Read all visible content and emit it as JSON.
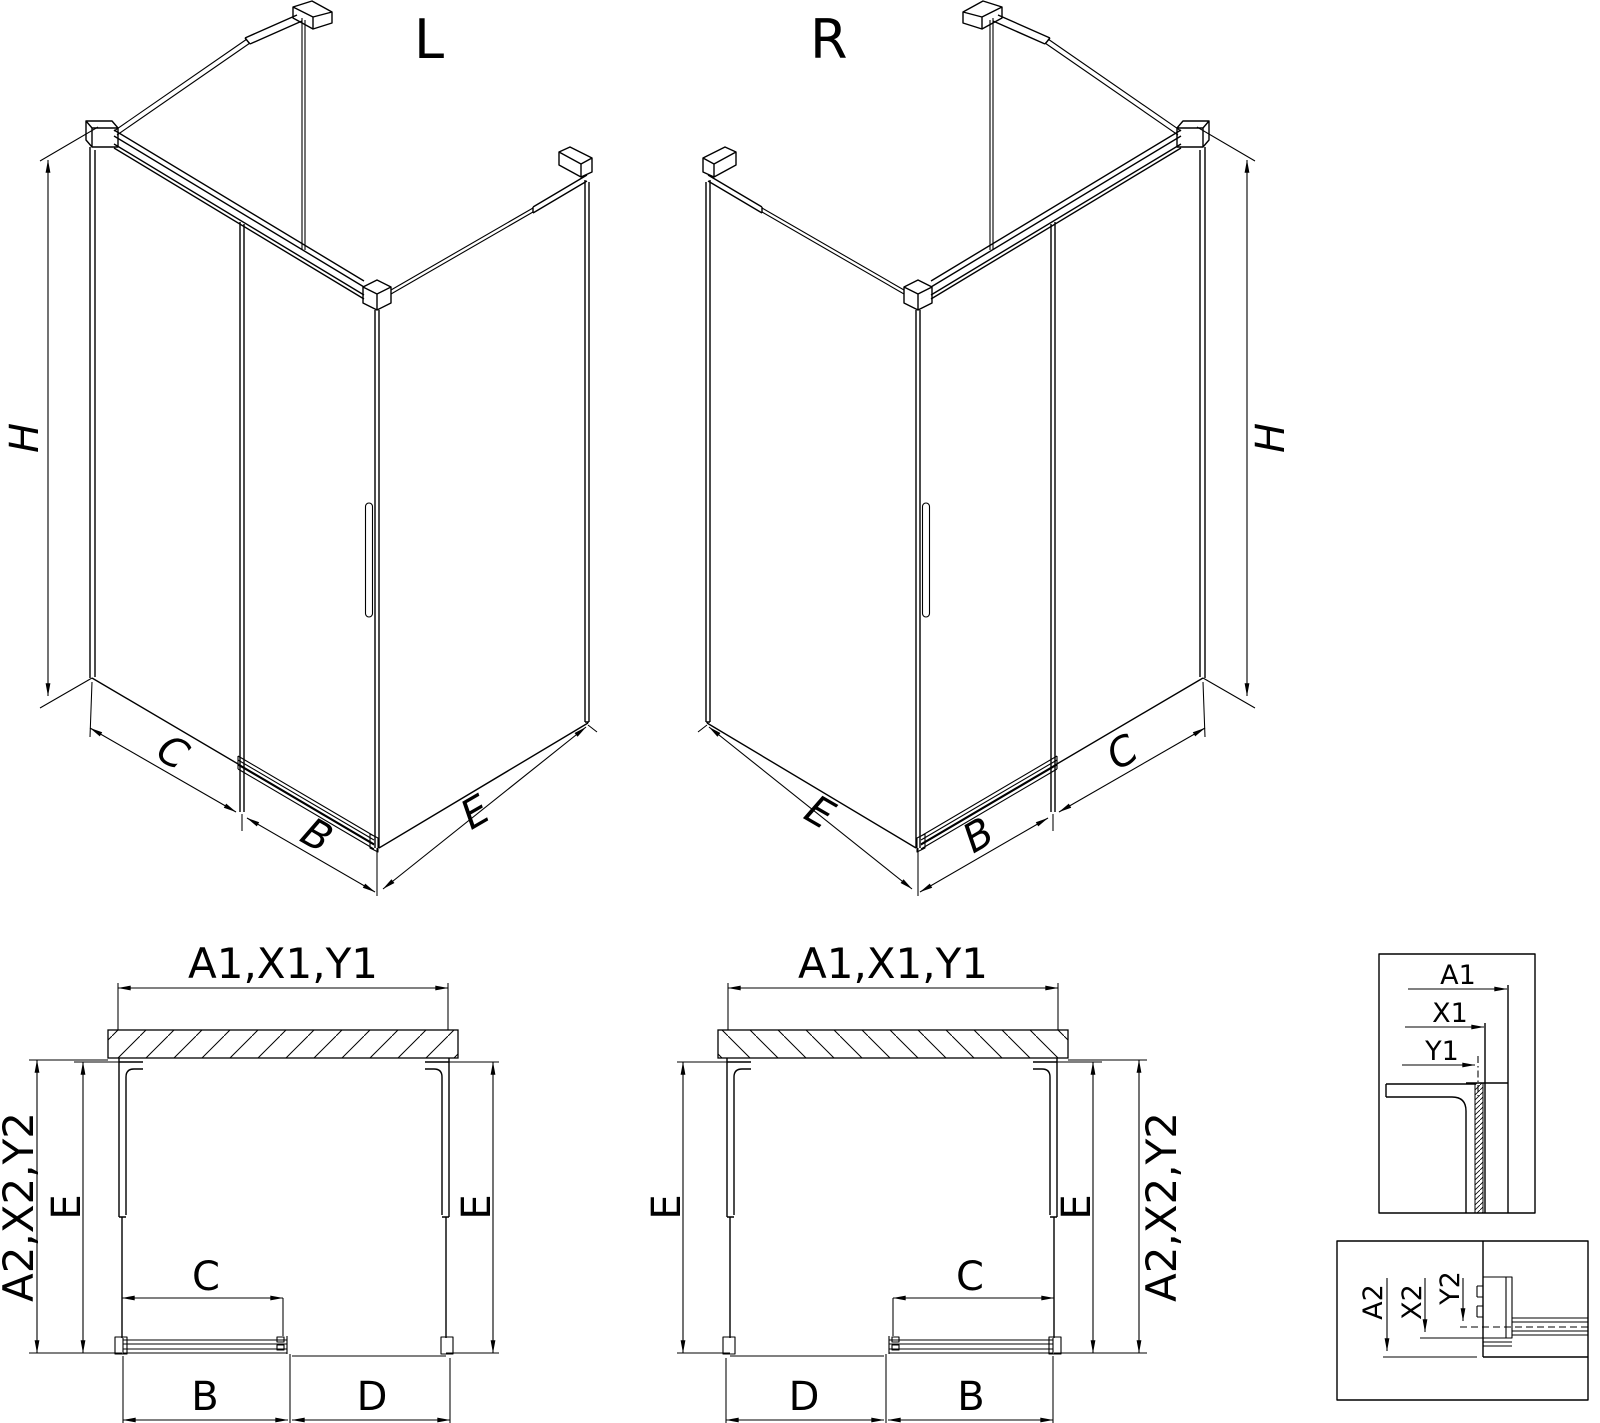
{
  "drawing": {
    "type": "shower-enclosure-technical-drawing",
    "colors": {
      "line": "#000000",
      "background": "#ffffff"
    }
  },
  "iso_views": {
    "left": {
      "title": "L",
      "dim_height": "H",
      "dim_fixed_panel": "C",
      "dim_door": "B",
      "dim_side_panel": "E"
    },
    "right": {
      "title": "R",
      "dim_height": "H",
      "dim_fixed_panel": "C",
      "dim_door": "B",
      "dim_side_panel": "E"
    }
  },
  "plan_views": {
    "left": {
      "dim_width_top": "A1,X1,Y1",
      "dim_depth_outer": "A2,X2,Y2",
      "dim_depth_left": "E",
      "dim_depth_right": "E",
      "dim_fixed_panel": "C",
      "dim_door": "B",
      "dim_opening": "D"
    },
    "right": {
      "dim_width_top": "A1,X1,Y1",
      "dim_depth_outer": "A2,X2,Y2",
      "dim_depth_left": "E",
      "dim_depth_right": "E",
      "dim_fixed_panel": "C",
      "dim_door": "B",
      "dim_opening": "D"
    }
  },
  "details": {
    "wall_profile": {
      "dim_a": "A1",
      "dim_x": "X1",
      "dim_y": "Y1"
    },
    "floor_profile": {
      "dim_a": "A2",
      "dim_x": "X2",
      "dim_y": "Y2"
    }
  }
}
